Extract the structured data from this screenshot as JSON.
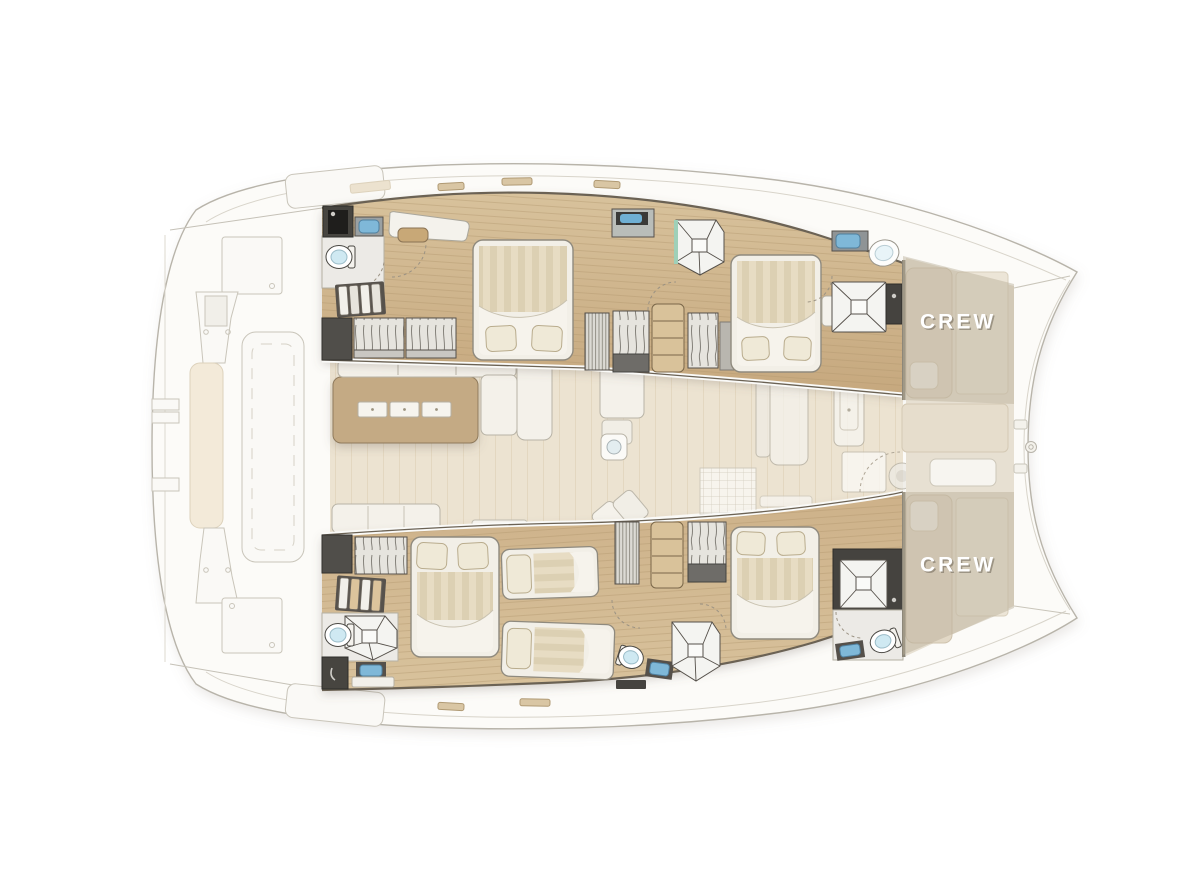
{
  "diagram": {
    "type": "yacht-floorplan",
    "subject": "catamaran deck plan, top-down view, bows pointing right"
  },
  "labels": {
    "crew_port": "CREW",
    "crew_starboard": "CREW"
  },
  "colors": {
    "background": "#ffffff",
    "ghost_hull_fill": "#fcfbf8",
    "ghost_hull_line": "#b8b4aa",
    "ghost_detail_line": "#cdc9be",
    "wood_floor_light": "#d8c29c",
    "wood_floor_dark": "#c2a479",
    "plank_line": "#b2976c",
    "saloon_floor": "#ece3d1",
    "galley_island": "#c4aa84",
    "upholstery_white": "#f4f1ea",
    "mattress_stripe_a": "#e7dcc3",
    "mattress_stripe_b": "#dcd0b3",
    "pillow": "#efe9d7",
    "dark_cabinet": "#4b4945",
    "wall_dark": "#6b6254",
    "sink_blue": "#7fb8d8",
    "toilet_water": "#cfe9f2",
    "shower_line": "#55504a",
    "crew_overlay": "#b9ac97",
    "crew_text": "#ffffff"
  },
  "icons": {
    "double-bed-icon": "rounded rect, striped mattress, white duvet fold, two pillows",
    "single-bed-icon": "rounded rect with one pillow",
    "shower-icon": "square tray with X mullions and center drain",
    "toilet-icon": "white oval bowl with blue water",
    "sink-icon": "blue basin in dark counter",
    "stairs-icon": "parallel step treads",
    "wardrobe-icon": "locker with hanging-clothes squiggles",
    "shelf-icon": "tan column with shelf lines",
    "deck-hatch-icon": "rounded square with circle",
    "windlass-icon": "double circle at bow beam"
  }
}
